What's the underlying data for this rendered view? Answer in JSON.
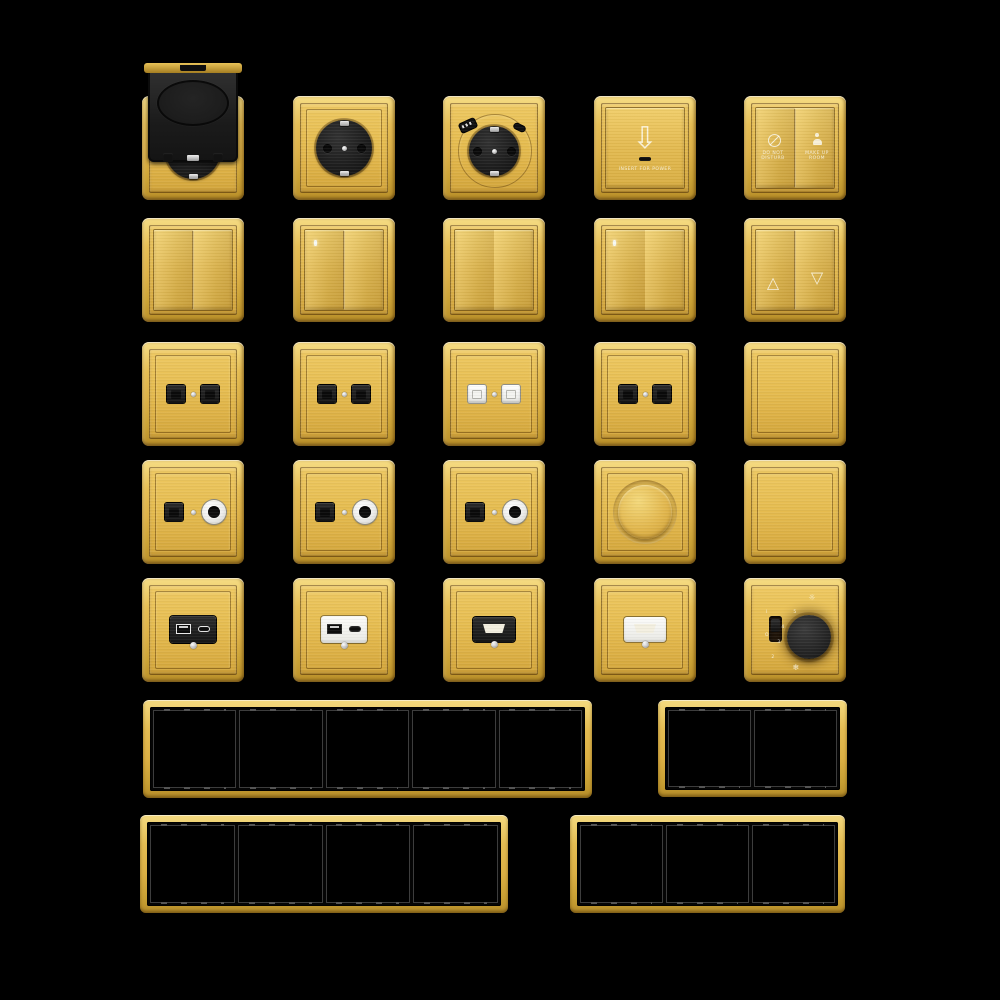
{
  "page": {
    "background": "#000000",
    "description": "gold brushed-brass switch and socket series collage"
  },
  "palette": {
    "gold_highlight": "#F6DD85",
    "gold": "#E2B94F",
    "gold_deep": "#B98F2A",
    "plate_gold": "#E9C45C",
    "module_black": "#1C1C1C",
    "module_white": "#F5F5F2",
    "silver": "#D9D9D9",
    "frame_inner_black": "#050505"
  },
  "labels": {
    "insert_for_power": "INSERT FOR POWER",
    "do_not_disturb": [
      "DO NOT",
      "DISTURB"
    ],
    "make_up_room": [
      "MAKE UP",
      "ROOM"
    ]
  },
  "icons": {
    "insert_arrow": "⇩",
    "up_triangle": "△",
    "down_triangle": "▽",
    "sun": "☼",
    "snow": "❄"
  },
  "thermostat": {
    "scale_top_to_bottom": [
      "5",
      "4",
      "3",
      "2"
    ],
    "on_label": "I",
    "off_label": "O"
  },
  "items": [
    {
      "name": "weatherproof-schuko-socket",
      "type": "cover_schuko",
      "row": 0,
      "col": 0
    },
    {
      "name": "schuko-socket",
      "type": "schuko",
      "row": 0,
      "col": 1
    },
    {
      "name": "schuko-usb-socket",
      "type": "schuko_usb",
      "row": 0,
      "col": 2
    },
    {
      "name": "key-card-power-switch",
      "type": "card",
      "row": 0,
      "col": 3
    },
    {
      "name": "hotel-service-switch",
      "type": "dnd",
      "row": 0,
      "col": 4
    },
    {
      "name": "two-gang-rocker-switch",
      "type": "rocker",
      "row": 1,
      "col": 0,
      "gangs": 2,
      "led": false
    },
    {
      "name": "two-gang-rocker-switch-led",
      "type": "rocker",
      "row": 1,
      "col": 1,
      "gangs": 2,
      "led": true
    },
    {
      "name": "one-gang-rocker-switch",
      "type": "rocker",
      "row": 1,
      "col": 2,
      "gangs": 1,
      "led": false
    },
    {
      "name": "one-gang-rocker-switch-led",
      "type": "rocker",
      "row": 1,
      "col": 3,
      "gangs": 1,
      "led": true
    },
    {
      "name": "curtain-switch",
      "type": "curtain",
      "row": 1,
      "col": 4
    },
    {
      "name": "dual-data-socket-black-1",
      "type": "data2",
      "row": 2,
      "col": 0,
      "color": "black"
    },
    {
      "name": "dual-data-socket-black-2",
      "type": "data2",
      "row": 2,
      "col": 1,
      "color": "black"
    },
    {
      "name": "dual-data-socket-white",
      "type": "data2",
      "row": 2,
      "col": 2,
      "color": "white"
    },
    {
      "name": "dual-data-socket-black-3",
      "type": "data2",
      "row": 2,
      "col": 3,
      "color": "black"
    },
    {
      "name": "blank-plate-1",
      "type": "blank",
      "row": 2,
      "col": 4
    },
    {
      "name": "tv-data-socket-1",
      "type": "datatv",
      "row": 3,
      "col": 0
    },
    {
      "name": "tv-data-socket-2",
      "type": "datatv",
      "row": 3,
      "col": 1
    },
    {
      "name": "tv-data-socket-3",
      "type": "datatv",
      "row": 3,
      "col": 2
    },
    {
      "name": "rotary-dimmer",
      "type": "dimmer",
      "row": 3,
      "col": 3
    },
    {
      "name": "blank-plate-2",
      "type": "blank",
      "row": 3,
      "col": 4
    },
    {
      "name": "usb-charger-black",
      "type": "usbmod",
      "row": 4,
      "col": 0,
      "color": "black"
    },
    {
      "name": "usb-charger-white",
      "type": "usbmod",
      "row": 4,
      "col": 1,
      "color": "white"
    },
    {
      "name": "hdmi-socket-black",
      "type": "hdmimod",
      "row": 4,
      "col": 2,
      "color": "black"
    },
    {
      "name": "hdmi-socket-white",
      "type": "hdmimod",
      "row": 4,
      "col": 3,
      "color": "white"
    },
    {
      "name": "thermostat-dial",
      "type": "thermo",
      "row": 4,
      "col": 4
    },
    {
      "name": "frame-5gang",
      "type": "frame",
      "gangs": 5
    },
    {
      "name": "frame-2gang",
      "type": "frame",
      "gangs": 2
    },
    {
      "name": "frame-4gang",
      "type": "frame",
      "gangs": 4
    },
    {
      "name": "frame-3gang",
      "type": "frame",
      "gangs": 3
    }
  ]
}
